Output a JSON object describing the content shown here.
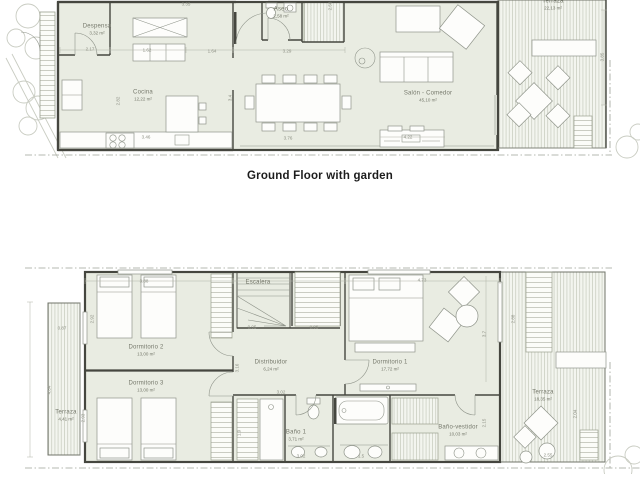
{
  "title": "Ground Floor with garden",
  "colors": {
    "room_fill": "#e9ece2",
    "wall": "#45463f",
    "furniture_stroke": "#8f948a",
    "label_text": "#75786b",
    "dim_text": "#8b8e82",
    "deck_line": "#c5cabc",
    "boundary": "#9fa398",
    "tree": "#c9ccc2",
    "title_text": "#1c1c1c"
  },
  "ground_floor": {
    "rooms": [
      {
        "label": "Despensa",
        "area": "3,32 m²",
        "x": 97,
        "y": 30
      },
      {
        "label": "Cocina",
        "area": "12,22 m²",
        "x": 143,
        "y": 96
      },
      {
        "label": "Aseo",
        "area": "2,58 m²",
        "x": 281,
        "y": 13
      },
      {
        "label": "Salón - Comedor",
        "area": "45,10 m²",
        "x": 428,
        "y": 97
      },
      {
        "label": "Terraza",
        "area": "22,13 m²",
        "x": 553,
        "y": 5
      }
    ],
    "dims": [
      {
        "t": "3.35",
        "x": 186,
        "y": 4
      },
      {
        "t": "2.17",
        "x": 90,
        "y": 49
      },
      {
        "t": "1.62",
        "x": 147,
        "y": 50
      },
      {
        "t": "1.64",
        "x": 212,
        "y": 51
      },
      {
        "t": "3.29",
        "x": 287,
        "y": 51
      },
      {
        "t": "2.82",
        "x": 118,
        "y": 101,
        "v": true
      },
      {
        "t": "3.4",
        "x": 230,
        "y": 98,
        "v": true
      },
      {
        "t": "2.58",
        "x": 330,
        "y": 6,
        "v": true
      },
      {
        "t": "3.46",
        "x": 146,
        "y": 137
      },
      {
        "t": "4.22",
        "x": 408,
        "y": 137
      },
      {
        "t": "3.76",
        "x": 288,
        "y": 138
      },
      {
        "t": "3.85",
        "x": 602,
        "y": 57,
        "v": true
      }
    ]
  },
  "first_floor": {
    "rooms": [
      {
        "label": "Dormitorio 2",
        "area": "13,00 m²",
        "x": 146,
        "y": 351
      },
      {
        "label": "Dormitorio 3",
        "area": "13,00 m²",
        "x": 146,
        "y": 387
      },
      {
        "label": "Escalera",
        "area": "",
        "x": 258,
        "y": 283
      },
      {
        "label": "Distribuidor",
        "area": "6,24 m²",
        "x": 271,
        "y": 366
      },
      {
        "label": "Dormitorio 1",
        "area": "17,72 m²",
        "x": 390,
        "y": 366
      },
      {
        "label": "Baño 1",
        "area": "3,71 m²",
        "x": 296,
        "y": 436
      },
      {
        "label": "Baño-vestidor",
        "area": "10,03 m²",
        "x": 458,
        "y": 431
      },
      {
        "label": "Terraza",
        "area": "4,41 m²",
        "x": 66,
        "y": 416
      },
      {
        "label": "Terraza",
        "area": "18,35 m²",
        "x": 543,
        "y": 396
      }
    ],
    "dims": [
      {
        "t": "3.88",
        "x": 144,
        "y": 281
      },
      {
        "t": "4.73",
        "x": 422,
        "y": 280
      },
      {
        "t": "0.87",
        "x": 62,
        "y": 328
      },
      {
        "t": "2.92",
        "x": 92,
        "y": 319,
        "v": true
      },
      {
        "t": "4.84",
        "x": 49,
        "y": 390,
        "v": true
      },
      {
        "t": "2.93",
        "x": 83,
        "y": 418,
        "v": true
      },
      {
        "t": "3.16",
        "x": 237,
        "y": 368,
        "v": true
      },
      {
        "t": "0.95",
        "x": 252,
        "y": 327
      },
      {
        "t": "0.95",
        "x": 314,
        "y": 327
      },
      {
        "t": "3.02",
        "x": 281,
        "y": 392
      },
      {
        "t": "1.9",
        "x": 239,
        "y": 433,
        "v": true
      },
      {
        "t": "3.02",
        "x": 301,
        "y": 456
      },
      {
        "t": "1.5",
        "x": 361,
        "y": 456
      },
      {
        "t": "3.7",
        "x": 484,
        "y": 334,
        "v": true
      },
      {
        "t": "2.88",
        "x": 513,
        "y": 319,
        "v": true
      },
      {
        "t": "2.15",
        "x": 484,
        "y": 423,
        "v": true
      },
      {
        "t": "2.04",
        "x": 575,
        "y": 414,
        "v": true
      },
      {
        "t": "2.55",
        "x": 548,
        "y": 455
      }
    ]
  }
}
